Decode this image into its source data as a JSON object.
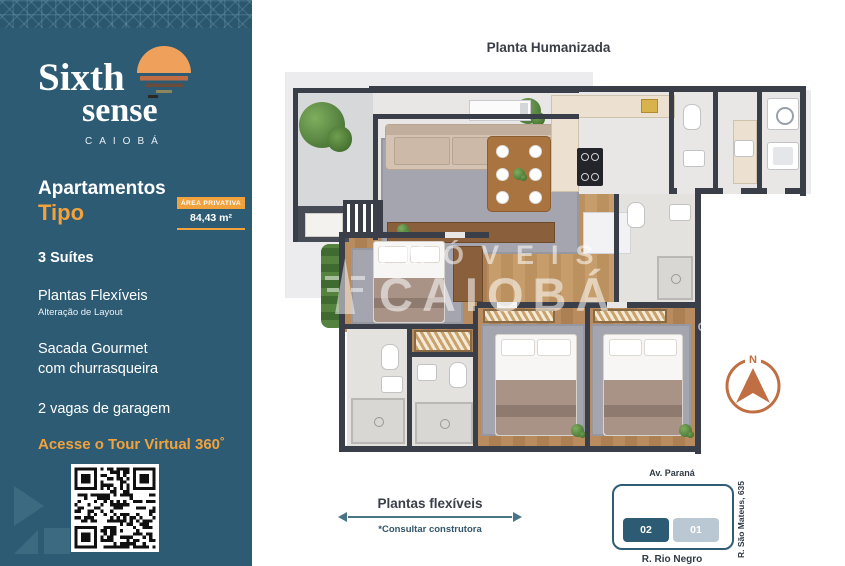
{
  "colors": {
    "sidebar_bg": "#2D5B74",
    "accent_orange": "#F2A23C",
    "sun_orange": "#EFA15B",
    "compass_orange": "#C06F44",
    "wall_dark": "#3A3E49",
    "teal_outline": "#2F5D77",
    "unit_01_bg": "#B9C8D2"
  },
  "sidebar": {
    "logo": {
      "word1": "Sixth",
      "word2": "sense",
      "subtitle": "CAIOBÁ",
      "icon": "sunset-logo-icon"
    },
    "heading_line1": "Apartamentos",
    "heading_line2": "Tipo",
    "area_badge": {
      "label": "ÁREA PRIVATIVA",
      "value": "84,43 m²"
    },
    "features": [
      {
        "text": "3 Suítes",
        "note": ""
      },
      {
        "text": "Plantas Flexíveis",
        "note": "Alteração de Layout"
      },
      {
        "text": "Sacada Gourmet com churrasqueira",
        "note": ""
      },
      {
        "text": "2 vagas de garagem",
        "note": ""
      }
    ],
    "tour_cta": "Acesse o Tour Virtual 360˚"
  },
  "main": {
    "title": "Planta Humanizada",
    "watermark": {
      "line1": "IMÓVEIS",
      "line2": "CAIOBÁ",
      "creci": "CRECI: J 8806"
    },
    "compass_label": "N",
    "flex_note": {
      "title": "Plantas flexíveis",
      "subtitle": "*Consultar construtora"
    },
    "location": {
      "street_top": "Av. Paraná",
      "street_bottom": "R. Rio Negro",
      "street_right": "R. São Mateus, 635",
      "units": [
        {
          "label": "02"
        },
        {
          "label": "01"
        }
      ]
    }
  }
}
